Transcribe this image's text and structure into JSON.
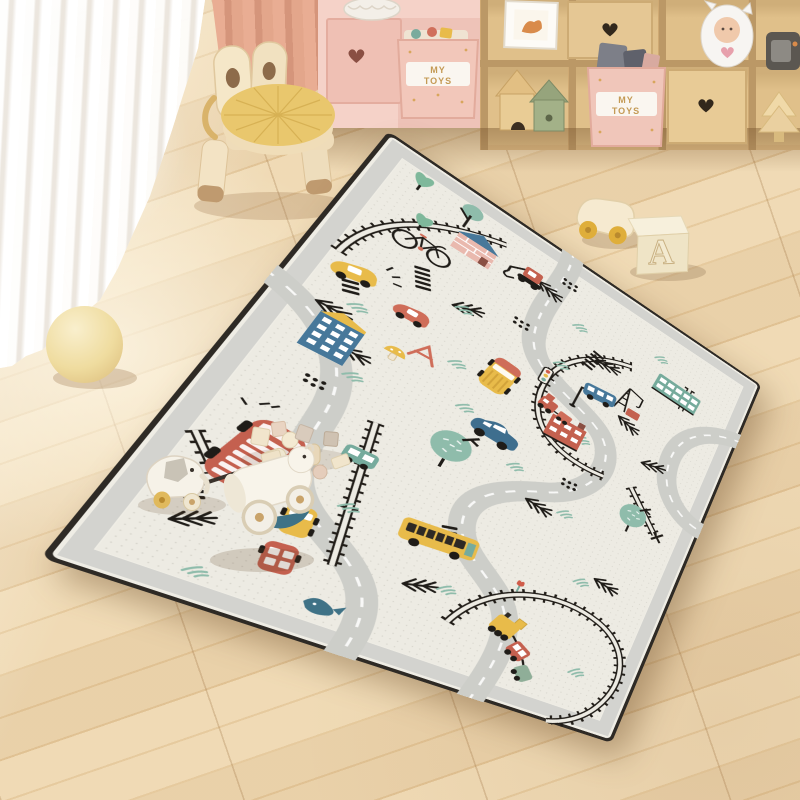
{
  "scene": {
    "type": "photograph",
    "description": "Children's playroom: a large cream road-map play rug with roads, train tracks and cartoon vehicles lies diagonally on a light wood plank floor; sheer white curtain and pink curtain at left, bunny-ear wooden stool with yellow cushion at top left, wooden cubby toy shelf at top right, cream ball on the floor, wooden toys scattered on the rug."
  },
  "labels": {
    "toy_bin_line1": "MY",
    "toy_bin_line2": "TOYS",
    "letter_block": "A"
  },
  "palette": {
    "floor": "#ecd5ae",
    "shelf_wood": "#dcba84",
    "pink_cabinet": "#f5d2c8",
    "bin_pink": "#f2c7ba",
    "label_gold": "#c49a55",
    "cushion_yellow": "#e9c76d",
    "rug_field": "#edebe3",
    "rug_gray_band": "#d3d3cf",
    "rug_trim": "#2e2a25",
    "road_gray": "#cdcec9",
    "track_black": "#211d18",
    "vehicle_red": "#c4604f",
    "vehicle_coral": "#d0705c",
    "vehicle_yellow": "#e8bb4a",
    "vehicle_teal": "#7aab9d",
    "vehicle_blue": "#47789a",
    "tree_green": "#8fbcab",
    "ball_cream": "#f0dfa6"
  },
  "rug": {
    "logical_size": [
      500,
      640
    ],
    "corners_px": [
      [
        388,
        130
      ],
      [
        762,
        385
      ],
      [
        612,
        744
      ],
      [
        38,
        558
      ]
    ],
    "motifs": [
      "winding roads",
      "train tracks",
      "crosswalks",
      "pine branches",
      "grass tufts",
      "pink house",
      "excavator",
      "bicycle",
      "yellow car",
      "red car",
      "blue building",
      "red brick building",
      "teal building",
      "crane",
      "blue bus",
      "red train",
      "yellow bus",
      "blue car",
      "double-decker bus",
      "school bus",
      "traffic lights",
      "street lamp",
      "trees",
      "tulip",
      "whale",
      "bottom train"
    ]
  },
  "objects": [
    {
      "name": "sheer-curtain",
      "desc": "white voile curtain, left"
    },
    {
      "name": "pink-curtain",
      "desc": "salmon pink curtain panel"
    },
    {
      "name": "stool",
      "desc": "wooden kids stool with rabbit-ear backrest and yellow round cushion"
    },
    {
      "name": "toy-shelf",
      "desc": "wooden cubby shelf with pink cabinet section"
    },
    {
      "name": "toy-bin-1",
      "desc": "pink fabric storage cube labeled MY TOYS"
    },
    {
      "name": "toy-bin-2",
      "desc": "pink fabric storage cube labeled MY TOYS with blocks"
    },
    {
      "name": "heart-drawers",
      "desc": "drawer fronts with heart cutouts (1 pink, 2 wood)"
    },
    {
      "name": "picture-frame",
      "desc": "white frame with fox artwork"
    },
    {
      "name": "wooden-houses",
      "desc": "natural and green wooden toy houses"
    },
    {
      "name": "monster-plush",
      "desc": "white horned plush with pink heart"
    },
    {
      "name": "speaker-toy",
      "desc": "gray toy radio"
    },
    {
      "name": "wooden-tree",
      "desc": "carved wooden tree"
    },
    {
      "name": "woven-basket",
      "desc": "white knit basket"
    },
    {
      "name": "play-rug",
      "desc": "cream city road play rug with gray border"
    },
    {
      "name": "cream-ball",
      "desc": "pale yellow ball on floor"
    },
    {
      "name": "wooden-car-toy",
      "desc": "cream wooden car with yellow wheels"
    },
    {
      "name": "letter-block",
      "desc": "ivory cube with embossed letter A"
    },
    {
      "name": "elephant-pull-toy",
      "desc": "white elephant pull toy with stick"
    },
    {
      "name": "lamb-roll-toy",
      "desc": "white cylinder animal toy on wooden wheels"
    },
    {
      "name": "wooden-blocks",
      "desc": "scattered small wooden blocks"
    }
  ]
}
